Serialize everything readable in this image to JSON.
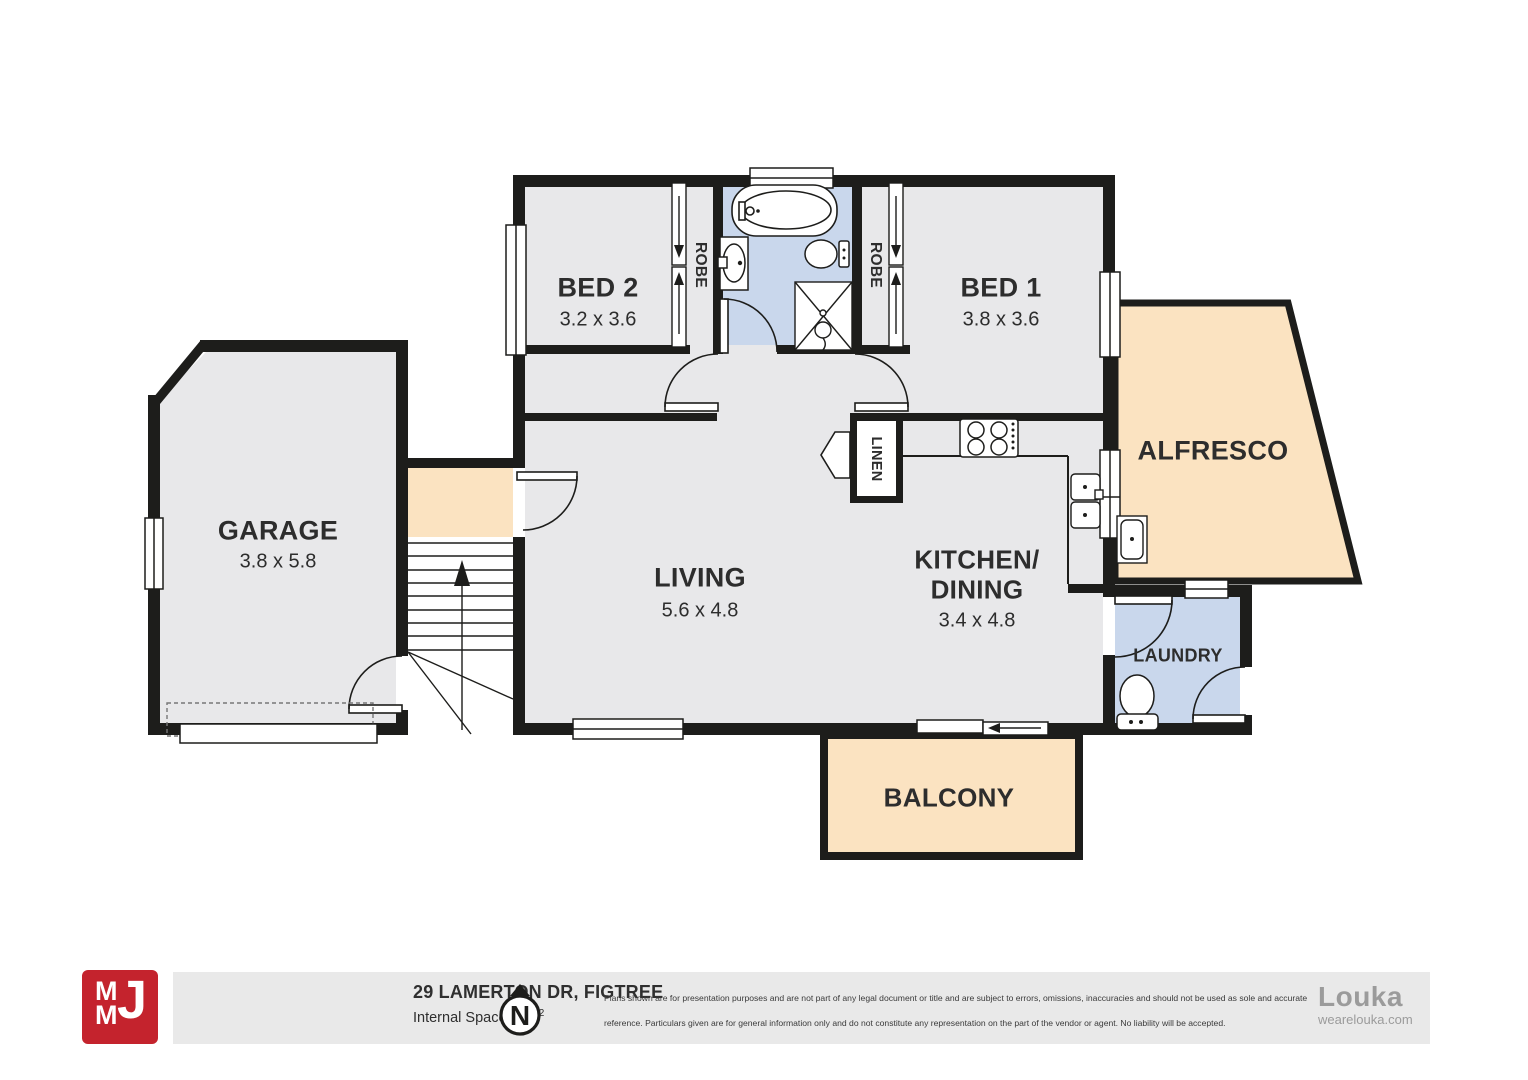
{
  "colors": {
    "wall": "#1d1d1b",
    "floor_gray": "#e8e8ea",
    "wet_blue": "#c9d7ec",
    "outdoor_peach": "#fbe3c1",
    "brand_red": "#c4232d",
    "footer_bg": "#e9e9e9",
    "louka_gray": "#9b9b9b"
  },
  "rooms": {
    "garage": {
      "label": "GARAGE",
      "dims": "3.8 x 5.8"
    },
    "bed2": {
      "label": "BED 2",
      "dims": "3.2 x 3.6"
    },
    "bed1": {
      "label": "BED 1",
      "dims": "3.8 x 3.6"
    },
    "living": {
      "label": "LIVING",
      "dims": "5.6 x 4.8"
    },
    "kitchen": {
      "label_line1": "KITCHEN/",
      "label_line2": "DINING",
      "dims": "3.4 x 4.8"
    },
    "alfresco": {
      "label": "ALFRESCO"
    },
    "balcony": {
      "label": "BALCONY"
    },
    "laundry": {
      "label": "LAUNDRY"
    },
    "linen": {
      "label": "LINEN"
    },
    "robe_left": {
      "label": "ROBE"
    },
    "robe_right": {
      "label": "ROBE"
    }
  },
  "footer": {
    "address": "29 LAMERTON DR, FIGTREE",
    "internal_space_prefix": "Internal Space 80m",
    "internal_space_sup": "2",
    "compass": "N",
    "brand": {
      "m1": "M",
      "m2": "M",
      "j": "J"
    },
    "disclaimer_line1": "Plans shown are for presentation purposes and are not part of any legal document or title and are subject to errors, omissions, inaccuracies and should not be used as sole and accurate",
    "disclaimer_line2": "reference. Particulars given are for general information only and do not constitute any representation on the part of the vendor or agent. No liability will be accepted.",
    "louka_name": "Louka",
    "louka_url": "wearelouka.com"
  }
}
